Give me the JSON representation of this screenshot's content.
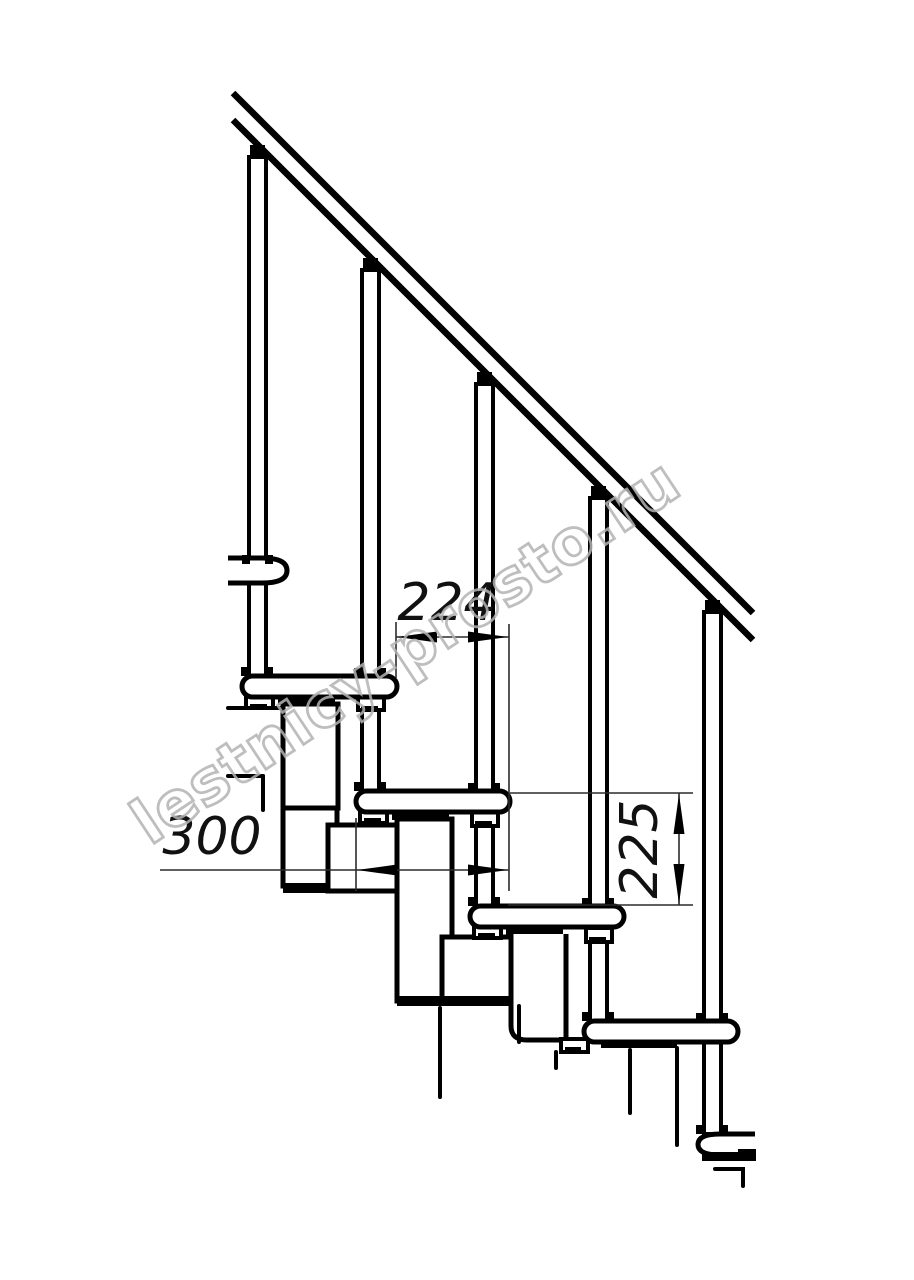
{
  "drawing": {
    "background_color": "#ffffff",
    "line_color": "#000000",
    "dimension_line_color": "#2b2b2b",
    "structure": {
      "handrail": 1,
      "balusters": 5,
      "treads": 5,
      "support_modules": 4
    },
    "dimensions": {
      "run": {
        "value": "224",
        "orientation": "horizontal"
      },
      "depth": {
        "value": "300",
        "orientation": "horizontal"
      },
      "rise": {
        "value": "225",
        "orientation": "vertical"
      }
    }
  },
  "watermark": {
    "text": "lestnicy-prosto.ru",
    "color": "#b3b3b3"
  }
}
